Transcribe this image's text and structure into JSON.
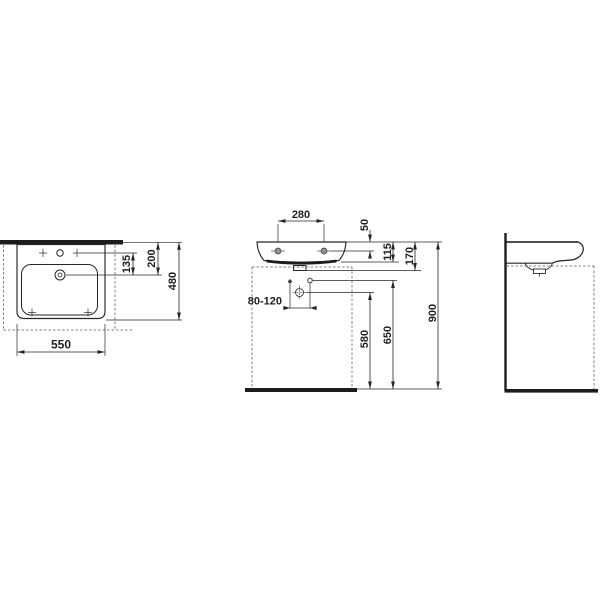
{
  "drawing": {
    "type": "technical-dimension-drawing",
    "subject": "wall-mounted washbasin shown in plan, front and side orthographic views",
    "colors": {
      "background": "#ffffff",
      "line": "#262626",
      "section_bar": "#1c1c1c",
      "dashed": "#5a5a5a",
      "hole_fill": "#8f8f8f"
    },
    "views": {
      "top": "plan view",
      "front": "front view",
      "side": "side view"
    },
    "dims": {
      "width": "550",
      "depth": "480",
      "tap_to_drain": "135",
      "rear_to_drain": "200",
      "tap_hole_spacing": "280",
      "top_to_fixing": "50",
      "top_to_underside": "115",
      "top_to_outlet": "170",
      "outlet_offset": "80-120",
      "floor_to_trap": "580",
      "floor_to_supply": "650",
      "mounting_height": "900"
    }
  }
}
